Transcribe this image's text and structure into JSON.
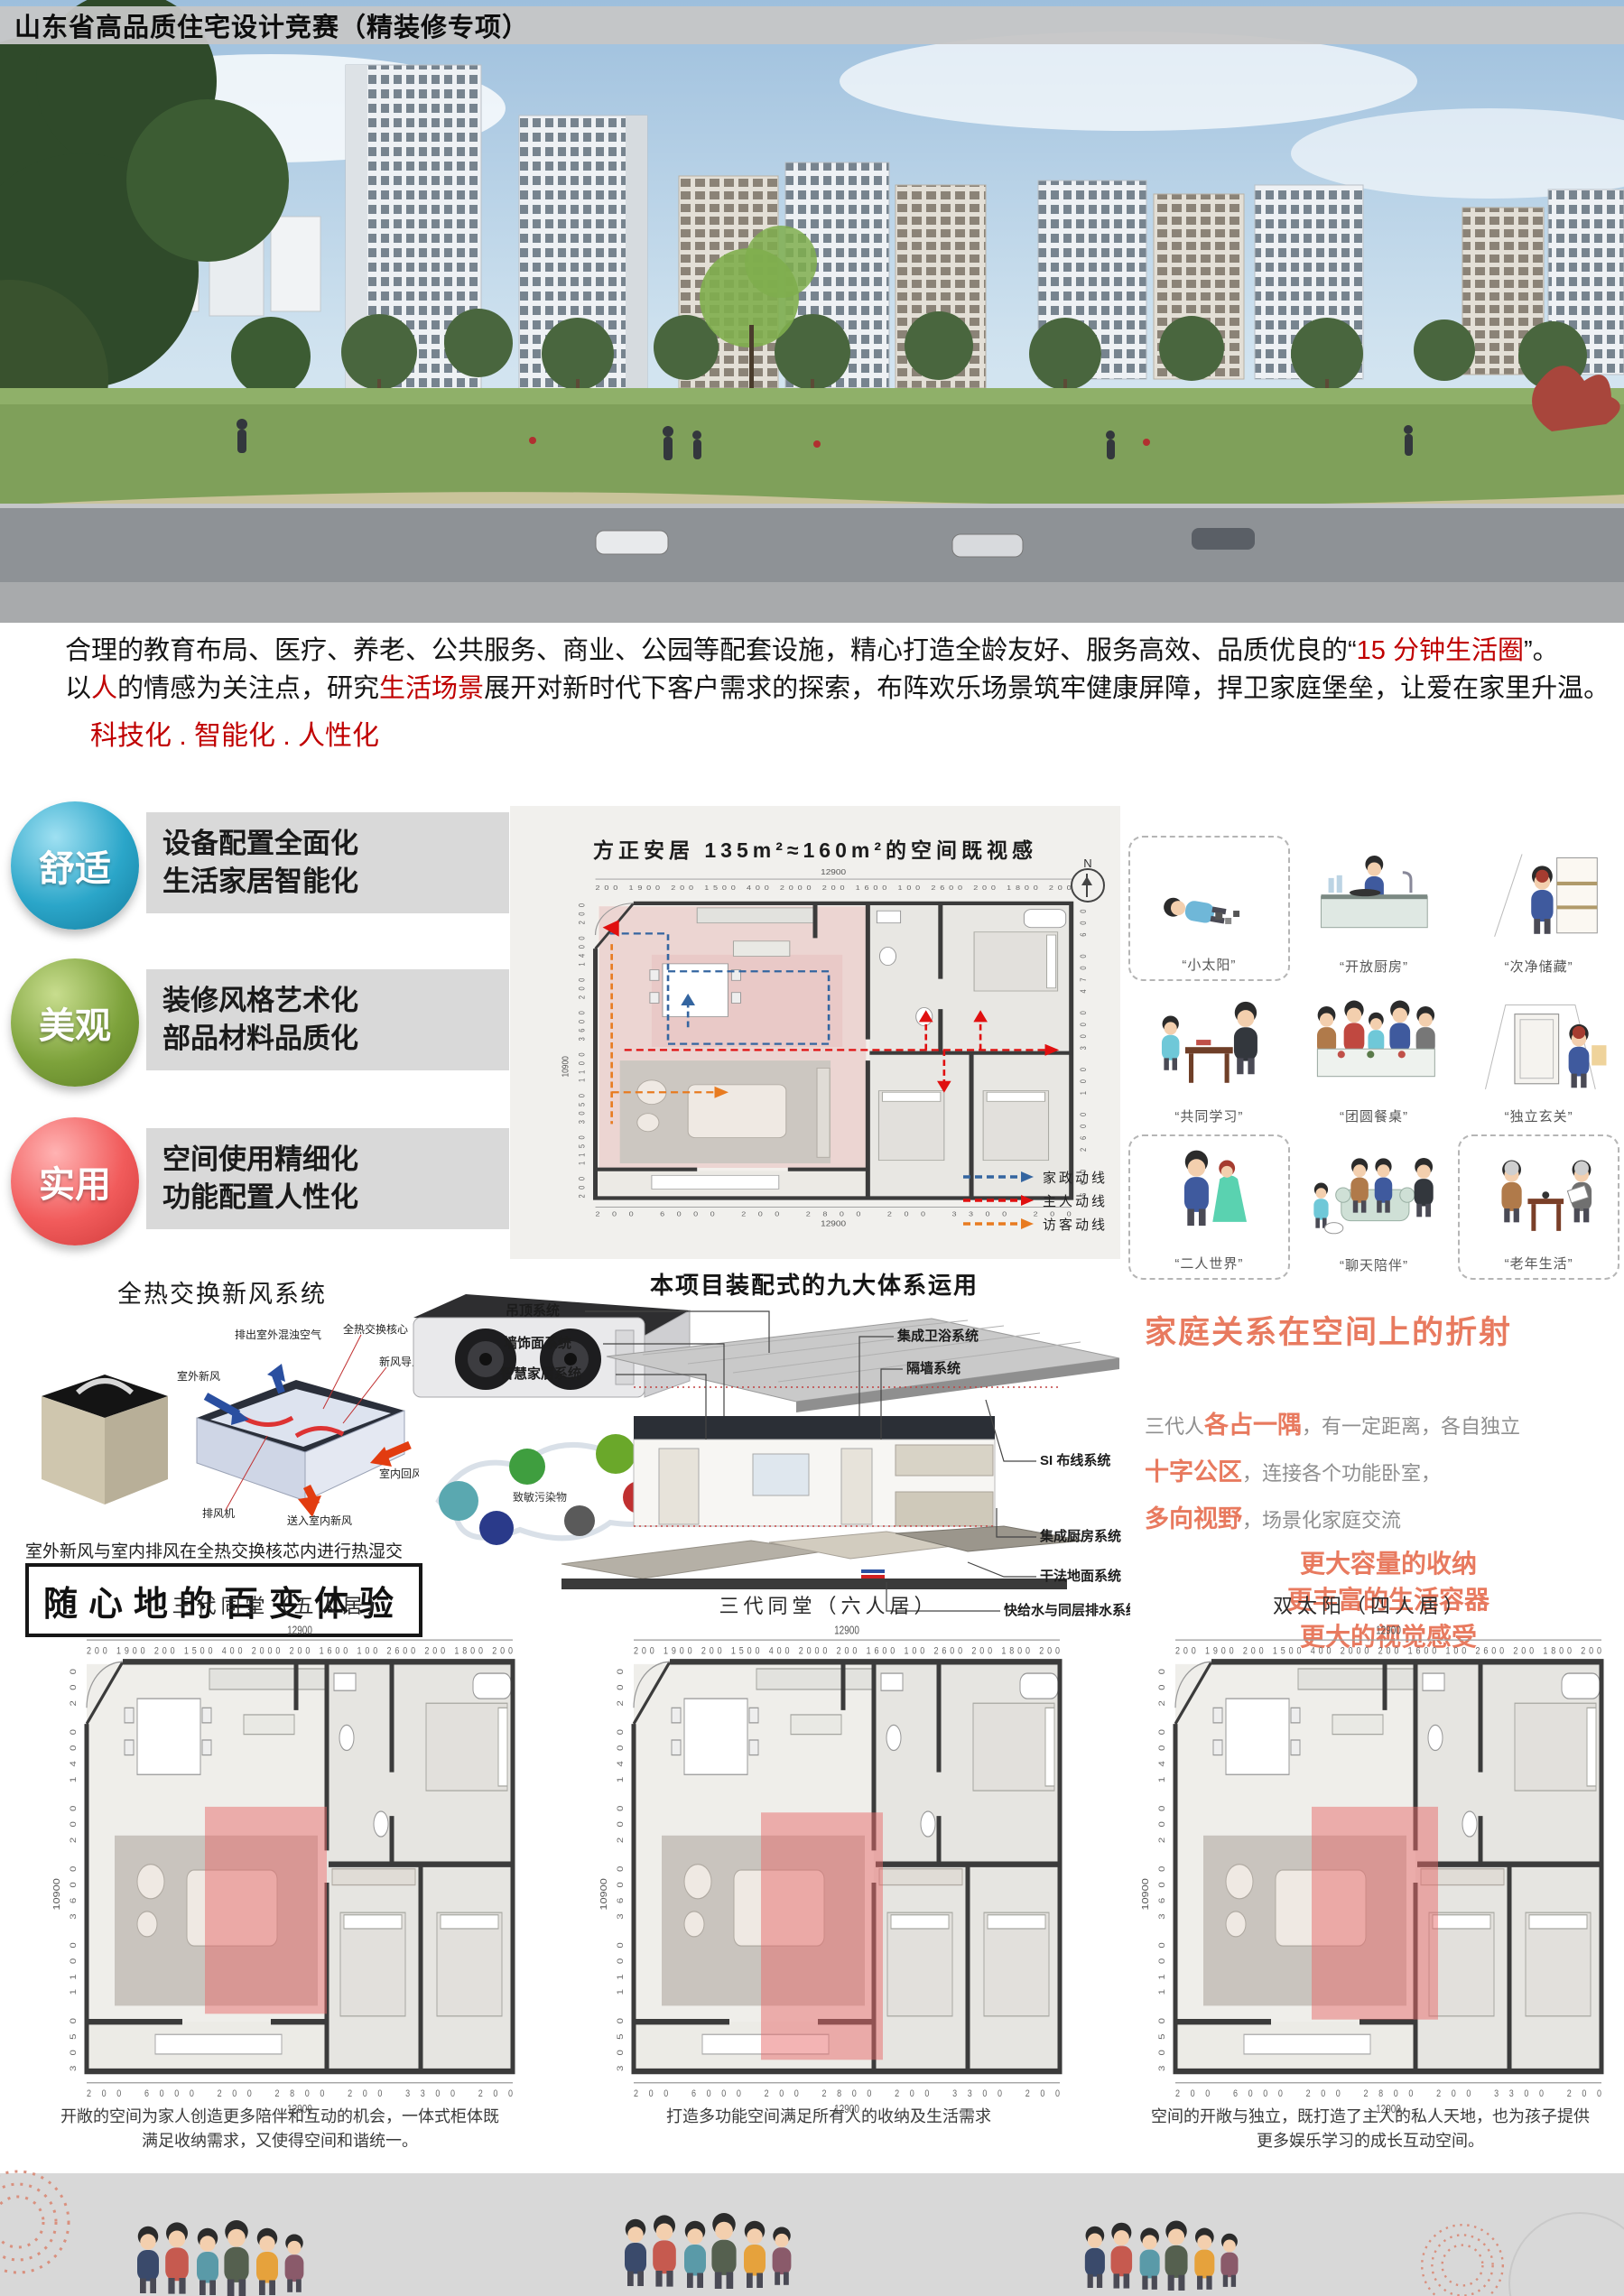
{
  "header": {
    "title": "山东省高品质住宅设计竞赛（精装修专项）"
  },
  "intro": {
    "p1_a": "合理的教育布局、医疗、养老、公共服务、商业、公园等配套设施，精心打造全龄友好、服务高效、品质优良的“",
    "p1_red": "15 分钟生活圈",
    "p1_b": "”。",
    "p2_a": "以",
    "p2_red1": "人",
    "p2_b": "的情感为关注点，研究",
    "p2_red2": "生活场景",
    "p2_c": "展开对新时代下客户需求的探索，布阵欢乐场景筑牢健康屏障，捍卫家庭堡垒，让爱在家里升温。",
    "slogan": "科技化 . 智能化 . 人性化",
    "accent_red": "#c00000"
  },
  "badges": [
    {
      "label": "舒适",
      "color": "#2ba6c9",
      "lines": [
        "设备配置全面化",
        "生活家居智能化"
      ]
    },
    {
      "label": "美观",
      "color": "#7da23b",
      "lines": [
        "装修风格艺术化",
        "部品材料品质化"
      ]
    },
    {
      "label": "实用",
      "color": "#f15b5b",
      "lines": [
        "空间使用精细化",
        "功能配置人性化"
      ]
    }
  ],
  "main_plan": {
    "title": "方正安居 135m²≈160m²的空间既视感",
    "north_label": "N",
    "dims": {
      "top_total": "12900",
      "top": "200 1900 200 1500 400 2000 200 1600 100 2600 200 1800 200",
      "left": "200 1150 3050 1100 3600 200 1400 200",
      "left_total": "10900",
      "right": "600 2600 100 3000 4700 600",
      "bottom": "200 6000 200 2800 200 3300 200",
      "bottom_total": "12900"
    },
    "legend": [
      {
        "label": "家政动线",
        "color": "#3465a0"
      },
      {
        "label": "主人动线",
        "color": "#e01010"
      },
      {
        "label": "访客动线",
        "color": "#e87b20"
      }
    ]
  },
  "scenes": {
    "items": [
      {
        "label": "“小太阳”"
      },
      {
        "label": "“开放厨房”"
      },
      {
        "label": "“次净储藏”"
      },
      {
        "label": "“共同学习”"
      },
      {
        "label": "“团圆餐桌”"
      },
      {
        "label": "“独立玄关”"
      },
      {
        "label": "“二人世界”"
      },
      {
        "label": "“聊天陪伴”"
      },
      {
        "label": "“老年生活”"
      }
    ]
  },
  "fresh_air": {
    "title": "全热交换新风系统",
    "caption": "室外新风与室内排风在全热交换核芯内进行热湿交换。",
    "labels": {
      "exhaust_out": "排出室外混浊空气",
      "core": "全热交换核心",
      "fresh_in": "新风导入",
      "outdoor_fresh": "室外新风",
      "exhaust_fan": "排风机",
      "indoor_return": "室内回风",
      "supply_indoor": "送入室内新风",
      "pollutant": "致敏污染物"
    }
  },
  "variety": {
    "title": "随心地的百变体验"
  },
  "nine_systems": {
    "title": "本项目装配式的九大体系运用",
    "left": [
      "吊顶系统",
      "墙饰面系统",
      "智慧家居系统"
    ],
    "right": [
      "集成卫浴系统",
      "隔墙系统",
      "SI 布线系统",
      "集成厨房系统",
      "干法地面系统",
      "快给水与同层排水系统"
    ]
  },
  "family": {
    "title": "家庭关系在空间上的折射",
    "line1_pre": "三代人",
    "line1_bold": "各占一隅",
    "line1_rest": "，有一定距离，各自独立",
    "line2_bold": "十字公区",
    "line2_rest": "，连接各个功能卧室，",
    "line3_bold": "多向视野",
    "line3_rest": "，场景化家庭交流",
    "big": [
      "更大容量的收纳",
      "更丰富的生活容器",
      "更大的视觉感受"
    ],
    "accent": "#e87a5f"
  },
  "plans": {
    "dims": {
      "top_total": "12900",
      "top": "200 1900 200 1500 400 2000 200 1600 100 2600 200 1800 200",
      "left": "3050 1100 3600 200 1400 200",
      "left_total": "10900",
      "bottom": "200 6000 200 2800 200 3300 200",
      "bottom_total": "12900"
    },
    "items": [
      {
        "title": "三代同堂（五人居）",
        "caption": "开敞的空间为家人创造更多陪伴和互动的机会，一体式柜体既满足收纳需求，又使得空间和谐统一。"
      },
      {
        "title": "三代同堂（六人居）",
        "caption": "打造多功能空间满足所有人的收纳及生活需求"
      },
      {
        "title": "双太阳（四人居）",
        "caption": "空间的开敞与独立，既打造了主人的私人天地，也为孩子提供更多娱乐学习的成长互动空间。"
      }
    ]
  }
}
